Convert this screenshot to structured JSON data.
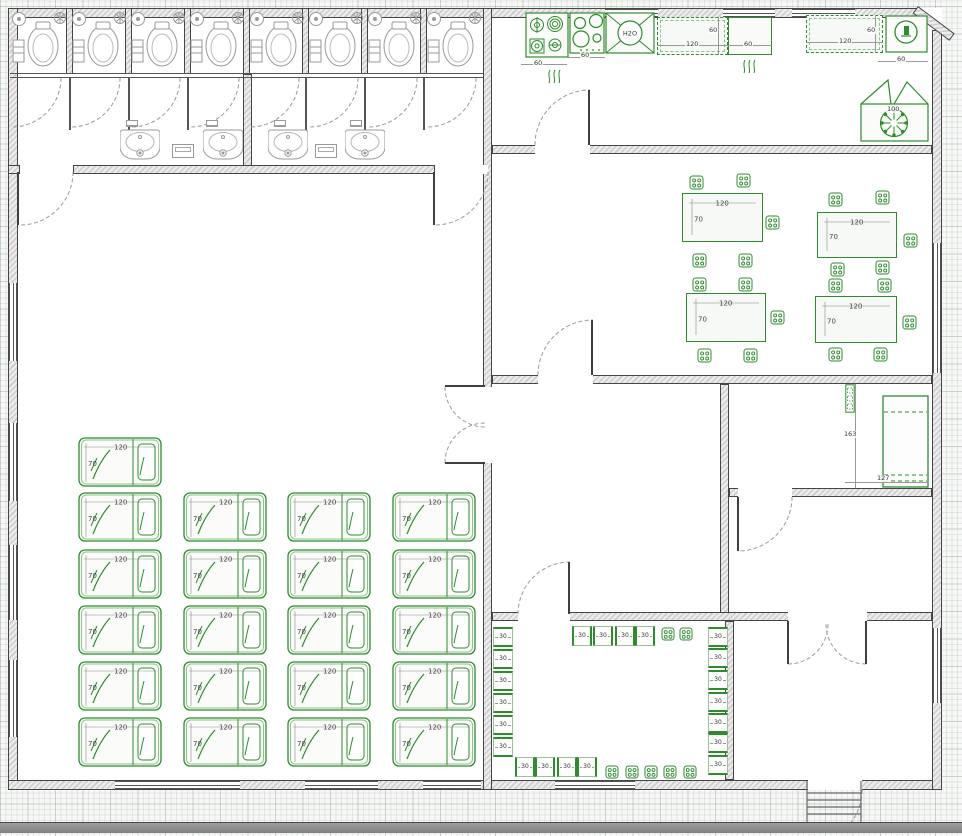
{
  "labels": {
    "bed_w": "120",
    "bed_h": "70",
    "table_w": "120",
    "table_h": "70",
    "stool": "30",
    "sink": "H2O"
  },
  "floorplan": {
    "footprint": {
      "x": 8,
      "y": 8,
      "w": 934,
      "h": 782
    },
    "walls": [
      {
        "x": 8,
        "y": 8,
        "w": 912,
        "h": 10
      },
      {
        "x": 8,
        "y": 8,
        "w": 10,
        "h": 782
      },
      {
        "x": 8,
        "y": 780,
        "w": 934,
        "h": 10
      },
      {
        "x": 932,
        "y": 30,
        "w": 10,
        "h": 760
      },
      {
        "x": 66,
        "y": 8,
        "w": 7,
        "h": 66
      },
      {
        "x": 125,
        "y": 8,
        "w": 7,
        "h": 66
      },
      {
        "x": 184,
        "y": 8,
        "w": 7,
        "h": 66
      },
      {
        "x": 243,
        "y": 8,
        "w": 7,
        "h": 66
      },
      {
        "x": 302,
        "y": 8,
        "w": 7,
        "h": 66
      },
      {
        "x": 361,
        "y": 8,
        "w": 7,
        "h": 66
      },
      {
        "x": 420,
        "y": 8,
        "w": 7,
        "h": 66
      },
      {
        "x": 243,
        "y": 74,
        "w": 9,
        "h": 95
      },
      {
        "x": 8,
        "y": 165,
        "w": 12,
        "h": 9
      },
      {
        "x": 73,
        "y": 165,
        "w": 362,
        "h": 9
      },
      {
        "x": 483,
        "y": 8,
        "w": 9,
        "h": 782
      },
      {
        "x": 492,
        "y": 145,
        "w": 440,
        "h": 9
      },
      {
        "x": 492,
        "y": 375,
        "w": 440,
        "h": 9
      },
      {
        "x": 720,
        "y": 384,
        "w": 9,
        "h": 237
      },
      {
        "x": 729,
        "y": 488,
        "w": 203,
        "h": 9
      },
      {
        "x": 492,
        "y": 612,
        "w": 440,
        "h": 9
      },
      {
        "x": 725,
        "y": 621,
        "w": 9,
        "h": 159
      }
    ],
    "gaps": [
      {
        "x": 20,
        "y": 165,
        "w": 53,
        "h": 9
      },
      {
        "x": 435,
        "y": 165,
        "w": 53,
        "h": 9
      },
      {
        "x": 483,
        "y": 387,
        "w": 9,
        "h": 76
      },
      {
        "x": 535,
        "y": 145,
        "w": 55,
        "h": 9
      },
      {
        "x": 538,
        "y": 375,
        "w": 55,
        "h": 9
      },
      {
        "x": 518,
        "y": 612,
        "w": 52,
        "h": 9
      },
      {
        "x": 738,
        "y": 488,
        "w": 54,
        "h": 9
      },
      {
        "x": 788,
        "y": 612,
        "w": 79,
        "h": 9
      },
      {
        "x": 808,
        "y": 780,
        "w": 54,
        "h": 10
      }
    ],
    "windows": [
      {
        "o": "v",
        "x": 9,
        "y": 283,
        "w": 8,
        "h": 78
      },
      {
        "o": "v",
        "x": 9,
        "y": 423,
        "w": 8,
        "h": 78
      },
      {
        "o": "v",
        "x": 9,
        "y": 545,
        "w": 8,
        "h": 75
      },
      {
        "o": "v",
        "x": 9,
        "y": 660,
        "w": 8,
        "h": 77
      },
      {
        "o": "h",
        "x": 605,
        "y": 9,
        "w": 53,
        "h": 8
      },
      {
        "o": "h",
        "x": 723,
        "y": 9,
        "w": 52,
        "h": 8
      },
      {
        "o": "h",
        "x": 792,
        "y": 9,
        "w": 63,
        "h": 8
      },
      {
        "o": "v",
        "x": 933,
        "y": 243,
        "w": 8,
        "h": 130
      },
      {
        "o": "v",
        "x": 933,
        "y": 628,
        "w": 8,
        "h": 75
      },
      {
        "o": "h",
        "x": 115,
        "y": 781,
        "w": 125,
        "h": 8
      },
      {
        "o": "h",
        "x": 305,
        "y": 781,
        "w": 73,
        "h": 8
      },
      {
        "o": "h",
        "x": 423,
        "y": 781,
        "w": 58,
        "h": 8
      },
      {
        "o": "h",
        "x": 555,
        "y": 781,
        "w": 80,
        "h": 8
      }
    ],
    "thin_lines": [
      {
        "x": 10,
        "y": 73,
        "w": 473,
        "h": 1
      },
      {
        "x": 10,
        "y": 77,
        "w": 473,
        "h": 1
      },
      {
        "x": 69,
        "y": 77,
        "w": 1.5,
        "h": 53
      },
      {
        "x": 128,
        "y": 77,
        "w": 1.5,
        "h": 53
      },
      {
        "x": 187,
        "y": 77,
        "w": 1.5,
        "h": 53
      },
      {
        "x": 305,
        "y": 77,
        "w": 1.5,
        "h": 53
      },
      {
        "x": 364,
        "y": 77,
        "w": 1.5,
        "h": 53
      },
      {
        "x": 423,
        "y": 77,
        "w": 1.5,
        "h": 53
      }
    ],
    "door_arcs": [
      {
        "d": "M61,78 A49 49 0 0 1 12,127"
      },
      {
        "d": "M120,78 A49 49 0 0 1 71,127"
      },
      {
        "d": "M180,78 A49 49 0 0 1 131,127"
      },
      {
        "d": "M239,78 A49 49 0 0 1 190,127"
      },
      {
        "d": "M299,78 A49 49 0 0 1 250,127"
      },
      {
        "d": "M358,78 A49 49 0 0 1 309,127"
      },
      {
        "d": "M417,78 A49 49 0 0 1 368,127"
      },
      {
        "d": "M476,78 A49 49 0 0 1 427,127"
      },
      {
        "d": "M73,172 A53 53 0 0 1 20,225"
      },
      {
        "d": "M488,172 A53 53 0 0 1 435,225"
      },
      {
        "d": "M535,145 A55 55 0 0 1 590,90"
      },
      {
        "d": "M538,375 A55 55 0 0 1 593,320"
      },
      {
        "d": "M445,387 A40 40 0 0 0 485,427"
      },
      {
        "d": "M445,463 A40 40 0 0 1 485,423"
      },
      {
        "d": "M518,614 A52 52 0 0 1 570,562"
      },
      {
        "d": "M792,497 A54 54 0 0 1 738,551"
      },
      {
        "d": "M788,664 A40 40 0 0 0 828,624"
      },
      {
        "d": "M866,664 A40 40 0 0 1 826,624"
      },
      {
        "d": "M862,790 A54 54 0 0 1 808,844"
      }
    ],
    "door_leaves": [
      [
        18,
        172,
        18,
        225
      ],
      [
        434,
        172,
        434,
        225
      ],
      [
        589,
        90,
        589,
        145
      ],
      [
        592,
        320,
        592,
        375
      ],
      [
        445,
        386,
        485,
        386
      ],
      [
        445,
        463,
        485,
        463
      ],
      [
        569,
        562,
        569,
        614
      ],
      [
        738,
        497,
        738,
        551
      ],
      [
        788,
        621,
        788,
        664
      ],
      [
        866,
        621,
        866,
        664
      ]
    ],
    "stalls": [
      {
        "x": 10
      },
      {
        "x": 70
      },
      {
        "x": 129
      },
      {
        "x": 188
      },
      {
        "x": 248
      },
      {
        "x": 307
      },
      {
        "x": 366
      },
      {
        "x": 425
      }
    ],
    "sinks": [
      {
        "x": 120,
        "y": 128
      },
      {
        "x": 203,
        "y": 128
      },
      {
        "x": 268,
        "y": 128
      },
      {
        "x": 345,
        "y": 128
      }
    ],
    "dispensers": [
      {
        "x": 172,
        "y": 144
      },
      {
        "x": 315,
        "y": 144
      }
    ],
    "hooks": [
      {
        "x": 126,
        "y": 120
      },
      {
        "x": 206,
        "y": 120
      },
      {
        "x": 274,
        "y": 120
      },
      {
        "x": 350,
        "y": 120
      }
    ],
    "beds": [
      {
        "x": 78,
        "y": 437
      },
      {
        "x": 78,
        "y": 492
      },
      {
        "x": 183,
        "y": 492
      },
      {
        "x": 287,
        "y": 492
      },
      {
        "x": 392,
        "y": 492
      },
      {
        "x": 78,
        "y": 549
      },
      {
        "x": 183,
        "y": 549
      },
      {
        "x": 287,
        "y": 549
      },
      {
        "x": 392,
        "y": 549
      },
      {
        "x": 78,
        "y": 605
      },
      {
        "x": 183,
        "y": 605
      },
      {
        "x": 287,
        "y": 605
      },
      {
        "x": 392,
        "y": 605
      },
      {
        "x": 78,
        "y": 661
      },
      {
        "x": 183,
        "y": 661
      },
      {
        "x": 287,
        "y": 661
      },
      {
        "x": 392,
        "y": 661
      },
      {
        "x": 78,
        "y": 717
      },
      {
        "x": 183,
        "y": 717
      },
      {
        "x": 287,
        "y": 717
      },
      {
        "x": 392,
        "y": 717
      }
    ],
    "tables": [
      {
        "x": 682,
        "y": 193,
        "w": 81,
        "h": 49
      },
      {
        "x": 817,
        "y": 212,
        "w": 80,
        "h": 46
      },
      {
        "x": 686,
        "y": 293,
        "w": 80,
        "h": 49
      },
      {
        "x": 815,
        "y": 296,
        "w": 82,
        "h": 47
      }
    ],
    "chairs": [
      {
        "x": 689,
        "y": 175,
        "s": 15
      },
      {
        "x": 736,
        "y": 173,
        "s": 15
      },
      {
        "x": 765,
        "y": 215,
        "s": 15
      },
      {
        "x": 692,
        "y": 253,
        "s": 15
      },
      {
        "x": 738,
        "y": 253,
        "s": 15
      },
      {
        "x": 828,
        "y": 192,
        "s": 15
      },
      {
        "x": 875,
        "y": 190,
        "s": 15
      },
      {
        "x": 903,
        "y": 233,
        "s": 15
      },
      {
        "x": 830,
        "y": 262,
        "s": 15
      },
      {
        "x": 875,
        "y": 260,
        "s": 15
      },
      {
        "x": 692,
        "y": 277,
        "s": 15
      },
      {
        "x": 738,
        "y": 277,
        "s": 15
      },
      {
        "x": 770,
        "y": 310,
        "s": 15
      },
      {
        "x": 697,
        "y": 348,
        "s": 15
      },
      {
        "x": 743,
        "y": 348,
        "s": 15
      },
      {
        "x": 828,
        "y": 278,
        "s": 15
      },
      {
        "x": 877,
        "y": 278,
        "s": 15
      },
      {
        "x": 902,
        "y": 315,
        "s": 15
      },
      {
        "x": 828,
        "y": 347,
        "s": 15
      },
      {
        "x": 873,
        "y": 347,
        "s": 15
      },
      {
        "x": 661,
        "y": 627,
        "s": 14
      },
      {
        "x": 679,
        "y": 627,
        "s": 14
      },
      {
        "x": 605,
        "y": 765,
        "s": 14
      },
      {
        "x": 625,
        "y": 765,
        "s": 14
      },
      {
        "x": 644,
        "y": 765,
        "s": 14
      },
      {
        "x": 663,
        "y": 765,
        "s": 14
      },
      {
        "x": 683,
        "y": 765,
        "s": 14
      }
    ],
    "stools": [
      {
        "x": 493,
        "y": 627,
        "o": "v"
      },
      {
        "x": 493,
        "y": 649,
        "o": "v"
      },
      {
        "x": 493,
        "y": 671,
        "o": "v"
      },
      {
        "x": 493,
        "y": 693,
        "o": "v"
      },
      {
        "x": 493,
        "y": 715,
        "o": "v"
      },
      {
        "x": 493,
        "y": 737,
        "o": "v"
      },
      {
        "x": 572,
        "y": 626,
        "o": "hz"
      },
      {
        "x": 593,
        "y": 626,
        "o": "hz"
      },
      {
        "x": 615,
        "y": 626,
        "o": "hz"
      },
      {
        "x": 635,
        "y": 626,
        "o": "hz"
      },
      {
        "x": 708,
        "y": 627,
        "o": "v"
      },
      {
        "x": 708,
        "y": 648,
        "o": "v"
      },
      {
        "x": 708,
        "y": 670,
        "o": "v"
      },
      {
        "x": 708,
        "y": 692,
        "o": "v"
      },
      {
        "x": 708,
        "y": 713,
        "o": "v"
      },
      {
        "x": 708,
        "y": 733,
        "o": "v"
      },
      {
        "x": 708,
        "y": 755,
        "o": "v"
      },
      {
        "x": 515,
        "y": 757,
        "o": "hz"
      },
      {
        "x": 535,
        "y": 757,
        "o": "hz"
      },
      {
        "x": 557,
        "y": 757,
        "o": "hz"
      },
      {
        "x": 577,
        "y": 757,
        "o": "hz"
      }
    ],
    "kitchen": {
      "stove": {
        "x": 525,
        "y": 12,
        "w": 44,
        "h": 46
      },
      "cooktop": {
        "x": 569,
        "y": 12,
        "w": 36,
        "h": 42
      },
      "sinkunit": {
        "x": 605,
        "y": 12,
        "w": 50,
        "h": 42
      },
      "counter1": {
        "x": 657,
        "y": 17,
        "w": 71,
        "h": 38
      },
      "oven": {
        "x": 728,
        "y": 17,
        "w": 44,
        "h": 38
      },
      "counter2": {
        "x": 806,
        "y": 15,
        "w": 77,
        "h": 38
      },
      "appliance": {
        "x": 885,
        "y": 15,
        "w": 43,
        "h": 38
      },
      "washer": {
        "x": 860,
        "y": 78,
        "w": 69,
        "h": 64
      },
      "waves1": {
        "x": 546,
        "y": 68,
        "w": 18,
        "h": 16
      },
      "waves2": {
        "x": 741,
        "y": 58,
        "w": 18,
        "h": 16
      }
    },
    "bedroom": {
      "bed2": {
        "x": 882,
        "y": 395,
        "w": 47,
        "h": 93
      },
      "side_item": {
        "x": 845,
        "y": 384,
        "w": 10,
        "h": 29
      }
    },
    "stairs": {
      "x": 804,
      "y": 781,
      "w": 60,
      "h": 41
    },
    "dims": [
      {
        "t": "60",
        "x": 533,
        "y": 60
      },
      {
        "t": "60",
        "x": 580,
        "y": 52
      },
      {
        "t": "120",
        "x": 685,
        "y": 41
      },
      {
        "t": "60",
        "x": 708,
        "y": 27
      },
      {
        "t": "60",
        "x": 743,
        "y": 41
      },
      {
        "t": "120",
        "x": 838,
        "y": 38
      },
      {
        "t": "60",
        "x": 866,
        "y": 27
      },
      {
        "t": "60",
        "x": 896,
        "y": 56
      },
      {
        "t": "100",
        "x": 886,
        "y": 106
      },
      {
        "t": "163",
        "x": 843,
        "y": 431
      },
      {
        "t": "127",
        "x": 876,
        "y": 475
      }
    ],
    "dim_lines": [
      {
        "x": 521,
        "y": 64,
        "w": 46,
        "h": 1
      },
      {
        "x": 567,
        "y": 57,
        "w": 38,
        "h": 1
      },
      {
        "x": 657,
        "y": 45,
        "w": 71,
        "h": 1
      },
      {
        "x": 718,
        "y": 17,
        "w": 1,
        "h": 38
      },
      {
        "x": 728,
        "y": 45,
        "w": 44,
        "h": 1
      },
      {
        "x": 806,
        "y": 42,
        "w": 77,
        "h": 1
      },
      {
        "x": 875,
        "y": 15,
        "w": 1,
        "h": 38
      },
      {
        "x": 878,
        "y": 61,
        "w": 50,
        "h": 1
      },
      {
        "x": 855,
        "y": 384,
        "w": 1,
        "h": 104
      },
      {
        "x": 845,
        "y": 482,
        "w": 84,
        "h": 1
      }
    ]
  }
}
